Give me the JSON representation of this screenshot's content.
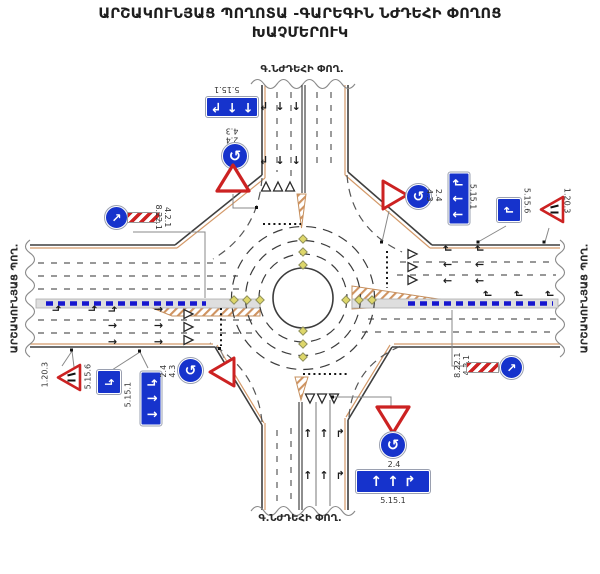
{
  "title": {
    "line1": "ԱՐՇԱԿՈՒՆՅԱՑ ՊՈՂՈՏԱ -ԳԱՐԵԳԻՆ ՆԺԴԵՀԻ ՓՈՂՈՑ",
    "line2": "ԽԱՉՄԵՐՈՒԿ"
  },
  "streets": {
    "north": "Գ.ՆԺԴԵՀԻ ՓՈՂ.",
    "south": "Գ.ՆԺԴԵՀԻ ՓՈՂ.",
    "west": "ԱՐՇԱԿՈՒՆՅԱՑ ՊՈՂ.",
    "east": "ԱՐՇԱԿՈՒՆՅԱՑ ՊՈՂ."
  },
  "sign_codes": {
    "lane_directions": "5.15.1",
    "lane_begins": "5.15.6",
    "road_narrows": "1.20.3",
    "give_way": "2.4",
    "roundabout": "4.3",
    "keep_right": "4.2.1",
    "obstacle_plate": "8.22.1"
  },
  "icons": {
    "roundabout_arrows": "↺",
    "keep_right_arrow": "↗",
    "arrow_straight": "↑",
    "arrow_right_hook": "↱",
    "arrow_left_hook": "↰"
  },
  "colors": {
    "sign_blue": "#1633cc",
    "sign_red": "#cc2222",
    "hatch_tan": "#cf9360",
    "stud_yellow": "#ded76a",
    "median_line_blue": "#1717cf"
  }
}
